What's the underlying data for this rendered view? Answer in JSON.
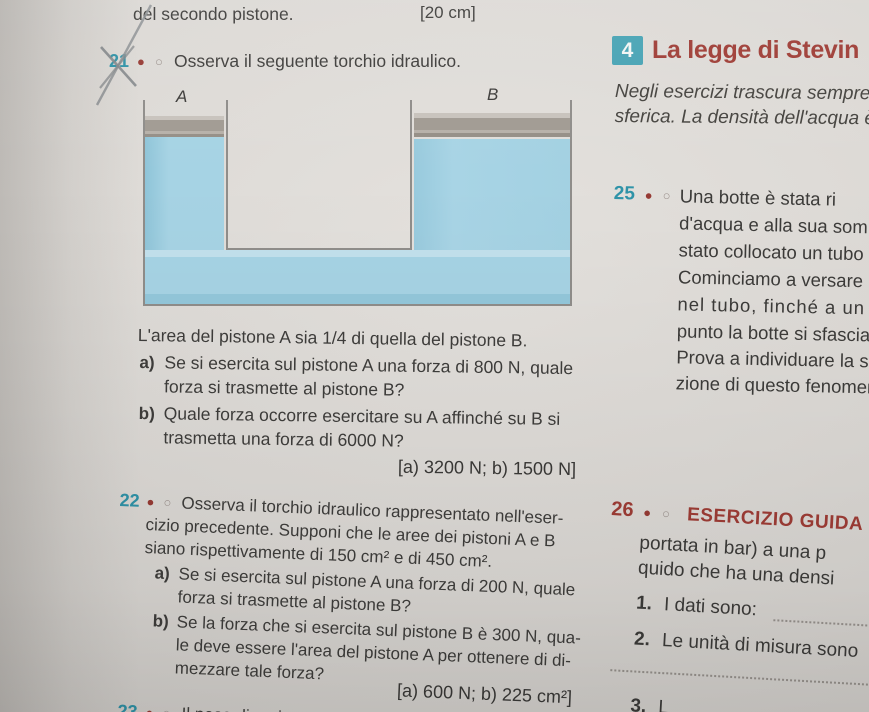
{
  "icons": {
    "dot_filled": "●",
    "dot_empty": "○"
  },
  "colors": {
    "teal": "#2f93a8",
    "maroon": "#9e3c35",
    "liquid": "#a3d1e2"
  },
  "top": {
    "fragment": "del secondo pistone.",
    "bracket_answer": "[20 cm]"
  },
  "section4": {
    "number": "4",
    "title": "La legge di Stevin",
    "intro_line1": "Negli esercizi trascura sempre",
    "intro_line2": "sferica. La densità dell'acqua è"
  },
  "ex21": {
    "number": "21",
    "prompt": "Osserva il seguente torchio idraulico.",
    "diagram_label_a": "A",
    "diagram_label_b": "B",
    "body": "L'area del pistone A sia 1/4 di quella del pistone B.",
    "a_label": "a)",
    "a_line1": "Se si esercita sul pistone A una forza di 800 N, quale",
    "a_line2": "forza si trasmette al pistone B?",
    "b_label": "b)",
    "b_line1": "Quale forza occorre esercitare su A affinché su B si",
    "b_line2": "trasmetta una forza di 6000 N?",
    "answer": "[a) 3200 N; b) 1500 N]"
  },
  "ex22": {
    "number": "22",
    "line1": "Osserva il torchio idraulico rappresentato nell'eser-",
    "line2": "cizio precedente. Supponi che le aree dei pistoni A e B",
    "line3": "siano rispettivamente di 150 cm² e di 450 cm².",
    "a_label": "a)",
    "a_line1": "Se si esercita sul pistone A una forza di 200 N, quale",
    "a_line2": "forza si trasmette al pistone B?",
    "b_label": "b)",
    "b_line1": "Se la forza che si esercita sul pistone B è 300 N, qua-",
    "b_line2": "le deve essere l'area del pistone A per ottenere di di-",
    "b_line3": "mezzare tale forza?",
    "answer": "[a) 600 N; b) 225 cm²]"
  },
  "ex23": {
    "number": "23",
    "fragment": "Il peso di un ippopotamo vi"
  },
  "ex25": {
    "number": "25",
    "lines": [
      "Una botte è stata ri",
      "d'acqua e alla sua som",
      "stato collocato un tubo",
      "Cominciamo a versare",
      "nel tubo, finché a un",
      "punto la botte si sfascia.",
      "Prova a individuare la s",
      "zione di questo fenomer"
    ]
  },
  "ex26": {
    "number": "26",
    "badge": "ESERCIZIO GUIDA",
    "line1": "portata in bar) a una p",
    "line2": "quido che ha una densi",
    "item1_num": "1.",
    "item1_text": "I dati sono:",
    "item2_num": "2.",
    "item2_text": "Le unità di misura sono",
    "item3_num": "3.",
    "item3_text": "L"
  }
}
